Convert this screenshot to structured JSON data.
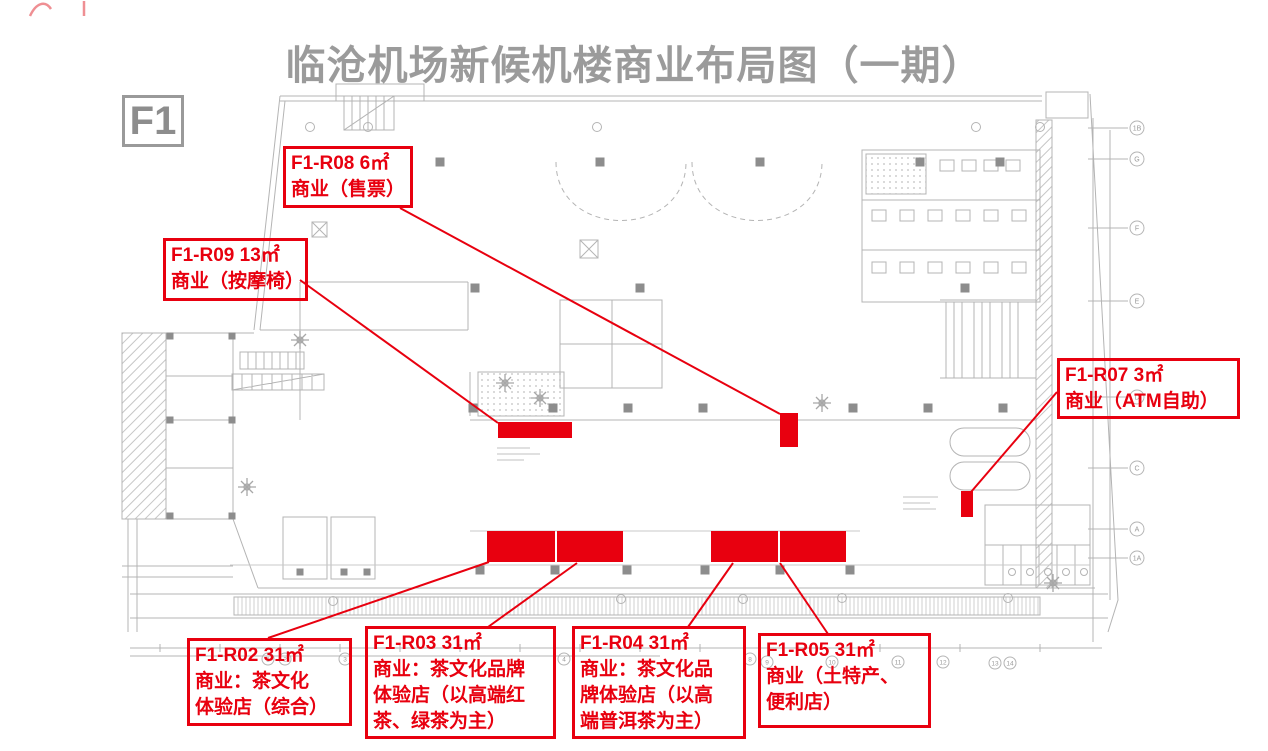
{
  "title": "临沧机场新候机楼商业布局图（一期）",
  "floor_badge": "F1",
  "colors": {
    "accent_red": "#e8000f",
    "plan_gray": "#b4b4b4",
    "title_gray": "#9b9b9b"
  },
  "annotations": {
    "r08": {
      "text": "F1-R08  6㎡\n商业（售票）"
    },
    "r09": {
      "text": "F1-R09  13㎡\n商业（按摩椅）"
    },
    "r07": {
      "text": "F1-R07  3㎡\n商业（ATM自助）"
    },
    "r02": {
      "text": "F1-R02  31㎡\n商业：茶文化\n体验店（综合）"
    },
    "r03": {
      "text": "F1-R03  31㎡\n商业：茶文化品牌\n体验店（以高端红\n茶、绿茶为主）"
    },
    "r04": {
      "text": "F1-R04  31㎡\n商业：茶文化品\n牌体验店（以高\n端普洱茶为主）"
    },
    "r05": {
      "text": "F1-R05  31㎡\n商业（土特产、\n便利店）"
    }
  },
  "grid": {
    "right_letters": [
      "1B",
      "G",
      "F",
      "E",
      "D",
      "C",
      "A",
      "1A"
    ],
    "bottom_numbers": [
      "1",
      "2",
      "3",
      "4",
      "8",
      "9",
      "10",
      "11",
      "12",
      "13",
      "14"
    ]
  }
}
